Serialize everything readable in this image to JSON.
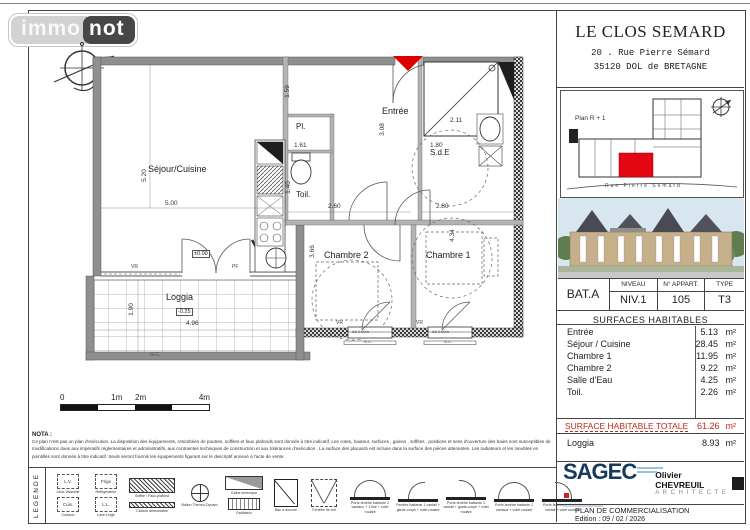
{
  "colors": {
    "accent_red": "#dd0000",
    "total_red": "#c0281c",
    "sagec_navy": "#17395a"
  },
  "header": {
    "logo_immo": "immo",
    "logo_not": "not"
  },
  "title_block": {
    "name": "LE CLOS SEMARD",
    "address1": "20 . Rue Pierre Sémard",
    "address2": "35120   DOL de BRETAGNE"
  },
  "site_plan": {
    "label": "Plan R + 1",
    "street": "Rue   Pierre   Sémard"
  },
  "apartment": {
    "building": "BAT.A",
    "col_level": "NIVEAU",
    "col_apart": "N° APPART.",
    "col_type": "TYPE",
    "level": "NIV.1",
    "apart": "105",
    "type": "T3"
  },
  "surfaces": {
    "title": "SURFACES  HABITABLES",
    "rows": [
      {
        "label": "Entrée",
        "value": "5.13",
        "unit": "m²"
      },
      {
        "label": "Séjour / Cuisine",
        "value": "28.45",
        "unit": "m²"
      },
      {
        "label": "Chambre 1",
        "value": "11.95",
        "unit": "m²"
      },
      {
        "label": "Chambre 2",
        "value": "9.22",
        "unit": "m²"
      },
      {
        "label": "Salle d'Eau",
        "value": "4.25",
        "unit": "m²"
      },
      {
        "label": "Toil.",
        "value": "2.26",
        "unit": "m²"
      }
    ],
    "total_label": "SURFACE HABITABLE TOTALE",
    "total_value": "61.26",
    "total_unit": "m²",
    "annex_label": "Loggia",
    "annex_value": "8.93",
    "annex_unit": "m²"
  },
  "branding": {
    "promoter": "SAGEC",
    "architect_name": "Olivier CHEVREUIL",
    "architect_title": "A R C H I T E C T E"
  },
  "doc_footer": {
    "title": "PLAN  DE  COMMERCIALISATION",
    "edition": "Edition : 09 / 02 / 2026"
  },
  "scale_bar": {
    "t0": "0",
    "t1": "1m",
    "t2": "2m",
    "t3": "4m"
  },
  "nota": {
    "title": "NOTA :",
    "text": "Ce plan n'est pas un plan d'exécution. La disposition des équipements, retombées de poutres, soffites et faux plafonds sont donnés à titre indicatif. Les cotes, hauteur, surfaces , gaines , soffites , positions et sens d'ouverture des baies sont susceptibles de modifications dues aux impératifs réglementaires et administratifs, aux contraintes techniques de construction et aux tolérances d'exécution . La surface des placards est incluse dans la surface des pièces attenantes. Les radiateurs et les meubles en pointillés sont donnés à titre indicatif. Seuls seront fournis les équipements figurant sur le descriptif annexé à l'acte de vente."
  },
  "legend": {
    "title": "LEGENDE",
    "items": [
      {
        "abbr": "L.V.",
        "label": "Lave-Vaisselle"
      },
      {
        "abbr": "Frigo",
        "label": "Réfrigérateur"
      },
      {
        "abbr": "Cuis.",
        "label": "Cuisson"
      },
      {
        "abbr": "L.L.",
        "label": "Lave-Linge"
      },
      {
        "label": "Soffite / Faux-plafond"
      },
      {
        "label": "Cloison démontable"
      },
      {
        "label": "Ballon Thermo-Dynam."
      },
      {
        "label": "Gaine technique"
      },
      {
        "label": "Radiateur"
      },
      {
        "label": "Bac à douche"
      },
      {
        "label": "Fenêtre de toit"
      },
      {
        "label": "Porte-fenêtre battante 2 vantaux + 1 fixe + volet roulant"
      },
      {
        "label": "Fenêtre battante 1 vantail + garde-corps + volet roulant"
      },
      {
        "label": "Porte-fenêtre battante 1 vantail + garde-corps + volet roulant"
      },
      {
        "label": "Porte-fenêtre battante 2 vantaux + volet roulant"
      },
      {
        "label": "Porte-fenêtre battante 1 vantail + volet roulant"
      }
    ]
  },
  "plan": {
    "rooms": {
      "sejour": "Séjour/Cuisine",
      "entree": "Entrée",
      "placard": "Pl.",
      "toilettes": "Toil.",
      "sde": "S.d.E",
      "chambre2": "Chambre 2",
      "chambre1": "Chambre 1",
      "loggia": "Loggia"
    },
    "dims": {
      "sejour_h": "5.20",
      "sejour_w": "5.00",
      "pl_h": "1.59",
      "pl_w": "1.61",
      "entree_w": "1.80",
      "entree_h": "3.08",
      "toil_h": "1.40",
      "hall_w": "2.60",
      "sde_w": "2.11",
      "c1_w": "2.80",
      "c2_h": "3.66",
      "c1_h": "4.34",
      "loggia_h": "1.90",
      "loggia_w": "4.96"
    },
    "levels": {
      "entry": "±0.00",
      "loggia": "-0.25"
    },
    "marks": {
      "vr": "VR",
      "pf": "PF",
      "gc": "G.C.",
      "sill": "Alt 0.60m"
    }
  }
}
